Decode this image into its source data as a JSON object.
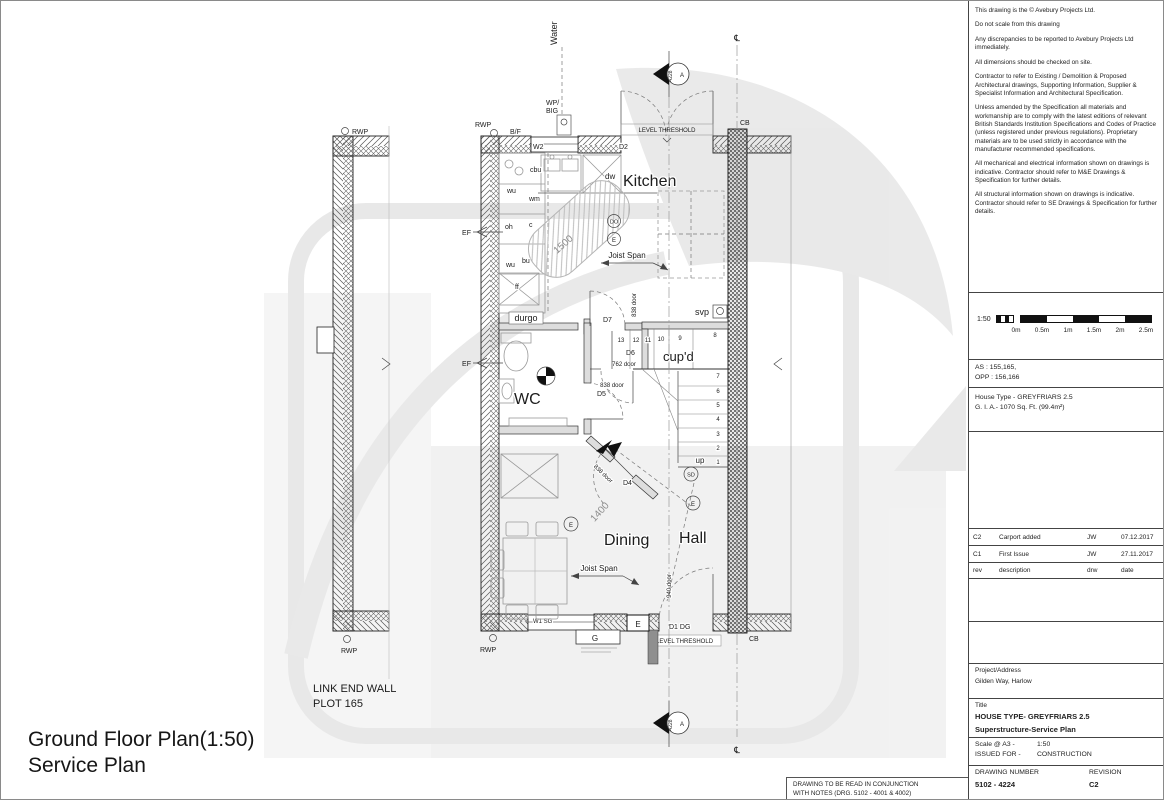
{
  "plan": {
    "heading": {
      "line1": "Ground Floor Plan(1:50)",
      "line2": "Service Plan"
    },
    "rooms": {
      "kitchen": "Kitchen",
      "wc": "WC",
      "dining": "Dining",
      "hall": "Hall",
      "cupd": "cup'd"
    },
    "kitchen_units": {
      "cbu": "cbu",
      "wu1": "wu",
      "wm": "wm",
      "oh": "oh",
      "c": "c",
      "wu2": "wu",
      "bu": "bu",
      "ff": "ff",
      "dw": "dw"
    },
    "plumbing": {
      "durgo": "durgo",
      "svp": "svp",
      "water": "Water",
      "wp_line1": "WP/",
      "wp_line2": "BIG",
      "bf": "B/F",
      "ef": "EF",
      "rwp": "RWP"
    },
    "doors": {
      "w2": "W2",
      "d2": "D2",
      "d7": "D7",
      "d6": "D6",
      "d5": "D5",
      "d4": "D4",
      "d1": "D1 DG",
      "w1": "W1 SG",
      "door838": "838 door",
      "door762": "762 door",
      "door940": "940 door"
    },
    "dims": {
      "kitchen_zone": "1500",
      "dining_zone": "1400"
    },
    "annotations": {
      "joist_span": "Joist Span",
      "level_threshold": "LEVEL THRESHOLD",
      "up": "up",
      "cb": "CB",
      "cl": "℄"
    },
    "symbols": {
      "do_mark": "DO",
      "e_mark": "E",
      "sd_mark": "SD",
      "g_mark": "G",
      "a_mark": "A",
      "section_number": "4228"
    },
    "stairs": {
      "top": [
        "13",
        "12",
        "11",
        "10",
        "9",
        "8"
      ],
      "side": [
        "7",
        "6",
        "5",
        "4",
        "3",
        "2",
        "1"
      ]
    },
    "neighbour": {
      "line1": "LINK END WALL",
      "line2": "PLOT 165"
    }
  },
  "titleblock": {
    "notes": [
      "This drawing is the ©  Avebury Projects Ltd.",
      "Do not scale from this drawing",
      "Any discrepancies to be reported to Avebury Projects Ltd immediately.",
      "All dimensions should be checked on site.",
      "Contractor to refer to Existing / Demolition & Proposed Architectural drawings, Supporting Information, Supplier & Specialist Information and Architectural Specification.",
      "Unless amended by the Specification all materials and workmanship are to comply with the latest editions of relevant British Standards Institution Specifications and Codes of Practice (unless registered under previous regulations). Proprietary materials are to be used strictly in accordance with the manufacturer recommended specifications.",
      "All mechanical and electrical information shown on drawings is indicative. Contractor should refer to M&E Drawings & Specification for further details.",
      "All structural information shown on drawings is indicative. Contractor should refer to SE Drawings & Specification for further details."
    ],
    "scalebar": {
      "ratio": "1:50",
      "ticks": [
        "0m",
        "0.5m",
        "1m",
        "1.5m",
        "2m",
        "2.5m"
      ]
    },
    "plots": {
      "as_line": "AS : 155,165,",
      "opp_line": "OPP : 156,166"
    },
    "house_type": {
      "line1": "House Type - GREYFRIARS 2.5",
      "line2": "G. I. A.- 1070 Sq. Ft. (99.4m²)"
    },
    "revisions": [
      {
        "rev": "C2",
        "description": "Carport added",
        "drw": "JW",
        "date": "07.12.2017"
      },
      {
        "rev": "C1",
        "description": "First Issue",
        "drw": "JW",
        "date": "27.11.2017"
      }
    ],
    "rev_header": {
      "rev": "rev",
      "description": "description",
      "drw": "drw",
      "date": "date"
    },
    "project": {
      "label": "Project/Address",
      "value": "Gilden Way, Harlow"
    },
    "title": {
      "label": "Title",
      "line1": "HOUSE TYPE- GREYFRIARS 2.5",
      "line2": "Superstructure-Service Plan"
    },
    "scale": {
      "label": "Scale @ A3 -",
      "value": "1:50"
    },
    "issued": {
      "label": "ISSUED FOR -",
      "value": "CONSTRUCTION"
    },
    "drawing_number": {
      "label": "DRAWING NUMBER",
      "value": "5102 - 4224"
    },
    "revision": {
      "label": "REVISION",
      "value": "C2"
    }
  },
  "footer_note": {
    "line1": "DRAWING TO BE READ IN CONJUNCTION",
    "line2": "WITH NOTES (DRG. 5102 - 4001 & 4002)"
  }
}
